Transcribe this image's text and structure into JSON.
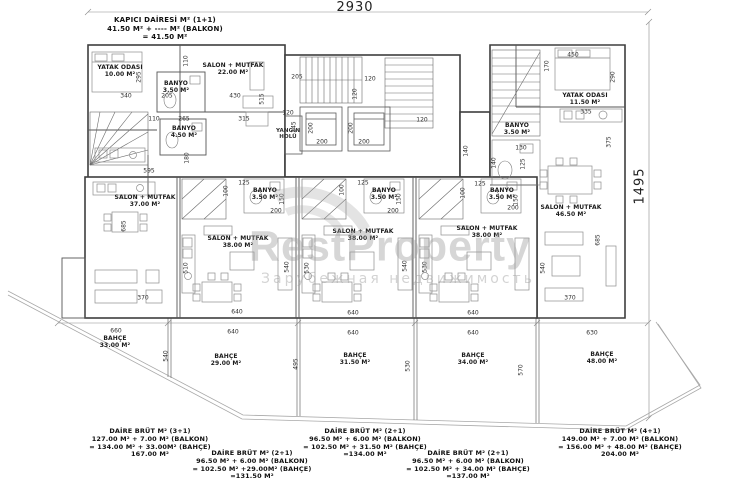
{
  "title_block": {
    "lines": [
      "KAPICI DAİRESİ M² (1+1)",
      "41.50 M² + ---- M² (BALKON)",
      "= 41.50 M²"
    ]
  },
  "overall_dims": {
    "width_label": "2930",
    "height_label": "1495"
  },
  "watermark": {
    "main": "RestProperty",
    "sub": "Зарубежная недвижимость"
  },
  "plan": {
    "rooms": [
      {
        "x": 120,
        "y": 72,
        "lines": [
          "YATAK ODASI",
          "10.00 M²"
        ]
      },
      {
        "x": 233,
        "y": 70,
        "lines": [
          "SALON + MUTFAK",
          "22.00 M²"
        ]
      },
      {
        "x": 176,
        "y": 88,
        "lines": [
          "BANYO",
          "3.50 M²"
        ]
      },
      {
        "x": 184,
        "y": 133,
        "lines": [
          "BANYO",
          "4.50 M²"
        ]
      },
      {
        "x": 288,
        "y": 134,
        "small": true,
        "lines": [
          "YANGIN",
          "HOLÜ"
        ]
      },
      {
        "x": 585,
        "y": 100,
        "lines": [
          "YATAK ODASI",
          "11.50 M²"
        ]
      },
      {
        "x": 517,
        "y": 130,
        "lines": [
          "BANYO",
          "3.50 M²"
        ]
      },
      {
        "x": 145,
        "y": 202,
        "lines": [
          "SALON + MUTFAK",
          "37.00 M²"
        ]
      },
      {
        "x": 265,
        "y": 195,
        "lines": [
          "BANYO",
          "3.50 M²"
        ]
      },
      {
        "x": 238,
        "y": 243,
        "lines": [
          "SALON + MUTFAK",
          "38.00 M²"
        ]
      },
      {
        "x": 384,
        "y": 195,
        "lines": [
          "BANYO",
          "3.50 M²"
        ]
      },
      {
        "x": 363,
        "y": 236,
        "lines": [
          "SALON + MUTFAK",
          "38.00 M²"
        ]
      },
      {
        "x": 502,
        "y": 195,
        "lines": [
          "BANYO",
          "3.50 M²"
        ]
      },
      {
        "x": 487,
        "y": 233,
        "lines": [
          "SALON + MUTFAK",
          "38.00 M²"
        ]
      },
      {
        "x": 571,
        "y": 212,
        "lines": [
          "SALON + MUTFAK",
          "46.50 M²"
        ]
      },
      {
        "x": 115,
        "y": 343,
        "lines": [
          "BAHÇE",
          "33.00 M²"
        ]
      },
      {
        "x": 226,
        "y": 361,
        "lines": [
          "BAHÇE",
          "29.00 M²"
        ]
      },
      {
        "x": 355,
        "y": 360,
        "lines": [
          "BAHÇE",
          "31.50 M²"
        ]
      },
      {
        "x": 473,
        "y": 360,
        "lines": [
          "BAHÇE",
          "34.00 M²"
        ]
      },
      {
        "x": 602,
        "y": 359,
        "lines": [
          "BAHÇE",
          "48.00 M²"
        ]
      }
    ],
    "dims": [
      {
        "t": "340",
        "x": 126,
        "y": 96
      },
      {
        "t": "295",
        "x": 139,
        "y": 77,
        "v": true
      },
      {
        "t": "205",
        "x": 167,
        "y": 96
      },
      {
        "t": "110",
        "x": 186,
        "y": 61,
        "v": true
      },
      {
        "t": "430",
        "x": 235,
        "y": 96
      },
      {
        "t": "515",
        "x": 262,
        "y": 99,
        "v": true
      },
      {
        "t": "110",
        "x": 154,
        "y": 119
      },
      {
        "t": "265",
        "x": 184,
        "y": 119
      },
      {
        "t": "315",
        "x": 244,
        "y": 119
      },
      {
        "t": "595",
        "x": 149,
        "y": 171
      },
      {
        "t": "180",
        "x": 187,
        "y": 158,
        "v": true
      },
      {
        "t": "120",
        "x": 288,
        "y": 113
      },
      {
        "t": "205",
        "x": 297,
        "y": 77
      },
      {
        "t": "120",
        "x": 370,
        "y": 79
      },
      {
        "t": "120",
        "x": 355,
        "y": 94,
        "v": true
      },
      {
        "t": "245",
        "x": 294,
        "y": 127,
        "v": true
      },
      {
        "t": "200",
        "x": 311,
        "y": 128,
        "v": true
      },
      {
        "t": "200",
        "x": 322,
        "y": 142
      },
      {
        "t": "200",
        "x": 351,
        "y": 128,
        "v": true
      },
      {
        "t": "200",
        "x": 364,
        "y": 142
      },
      {
        "t": "120",
        "x": 422,
        "y": 120
      },
      {
        "t": "140",
        "x": 466,
        "y": 151,
        "v": true
      },
      {
        "t": "140",
        "x": 494,
        "y": 163,
        "v": true
      },
      {
        "t": "125",
        "x": 523,
        "y": 164,
        "v": true
      },
      {
        "t": "130",
        "x": 521,
        "y": 148
      },
      {
        "t": "450",
        "x": 573,
        "y": 55
      },
      {
        "t": "170",
        "x": 547,
        "y": 66,
        "v": true
      },
      {
        "t": "290",
        "x": 613,
        "y": 77,
        "v": true
      },
      {
        "t": "335",
        "x": 586,
        "y": 112
      },
      {
        "t": "375",
        "x": 609,
        "y": 142,
        "v": true
      },
      {
        "t": "125",
        "x": 244,
        "y": 183
      },
      {
        "t": "100",
        "x": 226,
        "y": 191,
        "v": true
      },
      {
        "t": "150",
        "x": 282,
        "y": 199,
        "v": true
      },
      {
        "t": "200",
        "x": 276,
        "y": 211
      },
      {
        "t": "125",
        "x": 363,
        "y": 183
      },
      {
        "t": "100",
        "x": 342,
        "y": 190,
        "v": true
      },
      {
        "t": "150",
        "x": 399,
        "y": 199,
        "v": true
      },
      {
        "t": "200",
        "x": 393,
        "y": 211
      },
      {
        "t": "125",
        "x": 480,
        "y": 184
      },
      {
        "t": "100",
        "x": 463,
        "y": 193,
        "v": true
      },
      {
        "t": "150",
        "x": 516,
        "y": 200,
        "v": true
      },
      {
        "t": "200",
        "x": 513,
        "y": 208
      },
      {
        "t": "685",
        "x": 124,
        "y": 226,
        "v": true
      },
      {
        "t": "510",
        "x": 186,
        "y": 268,
        "v": true
      },
      {
        "t": "540",
        "x": 287,
        "y": 267,
        "v": true
      },
      {
        "t": "530",
        "x": 307,
        "y": 268,
        "v": true
      },
      {
        "t": "540",
        "x": 405,
        "y": 266,
        "v": true
      },
      {
        "t": "530",
        "x": 425,
        "y": 267,
        "v": true
      },
      {
        "t": "540",
        "x": 543,
        "y": 268,
        "v": true
      },
      {
        "t": "685",
        "x": 598,
        "y": 240,
        "v": true
      },
      {
        "t": "370",
        "x": 143,
        "y": 298
      },
      {
        "t": "640",
        "x": 237,
        "y": 312
      },
      {
        "t": "640",
        "x": 353,
        "y": 313
      },
      {
        "t": "640",
        "x": 473,
        "y": 313
      },
      {
        "t": "370",
        "x": 570,
        "y": 298
      },
      {
        "t": "660",
        "x": 116,
        "y": 331
      },
      {
        "t": "640",
        "x": 233,
        "y": 332
      },
      {
        "t": "640",
        "x": 353,
        "y": 333
      },
      {
        "t": "640",
        "x": 473,
        "y": 333
      },
      {
        "t": "630",
        "x": 592,
        "y": 333
      },
      {
        "t": "540",
        "x": 166,
        "y": 356,
        "v": true
      },
      {
        "t": "495",
        "x": 296,
        "y": 364,
        "v": true
      },
      {
        "t": "530",
        "x": 408,
        "y": 366,
        "v": true
      },
      {
        "t": "570",
        "x": 521,
        "y": 370,
        "v": true
      }
    ]
  },
  "bottom_notes": [
    {
      "x": 150,
      "y": 428,
      "lines": [
        "DAİRE BRÜT M² (3+1)",
        "127.00 M² + 7.00 M² (BALKON)",
        "= 134.00 M² + 33.00M² (BAHÇE)",
        "167.00 M²"
      ]
    },
    {
      "x": 252,
      "y": 450,
      "lines": [
        "DAİRE BRÜT M² (2+1)",
        "96.50 M² + 6.00 M² (BALKON)",
        "= 102.50 M² +29.00M² (BAHÇE)",
        "=131.50 M²"
      ]
    },
    {
      "x": 365,
      "y": 428,
      "lines": [
        "DAİRE BRÜT M² (2+1)",
        "96.50 M² + 6.00 M² (BALKON)",
        "= 102.50 M² + 31.50 M² (BAHÇE)",
        "=134.00 M²"
      ]
    },
    {
      "x": 468,
      "y": 450,
      "lines": [
        "DAİRE BRÜT M² (2+1)",
        "96.50 M² + 6.00 M² (BALKON)",
        "= 102.50 M² + 34.00 M² (BAHÇE)",
        "=137.00 M²"
      ]
    },
    {
      "x": 620,
      "y": 428,
      "lines": [
        "DAİRE BRÜT M² (4+1)",
        "149.00 M² + 7.00 M² (BALKON)",
        "= 156.00 M² + 48.00 M² (BAHÇE)",
        "204.00 M²"
      ]
    }
  ]
}
